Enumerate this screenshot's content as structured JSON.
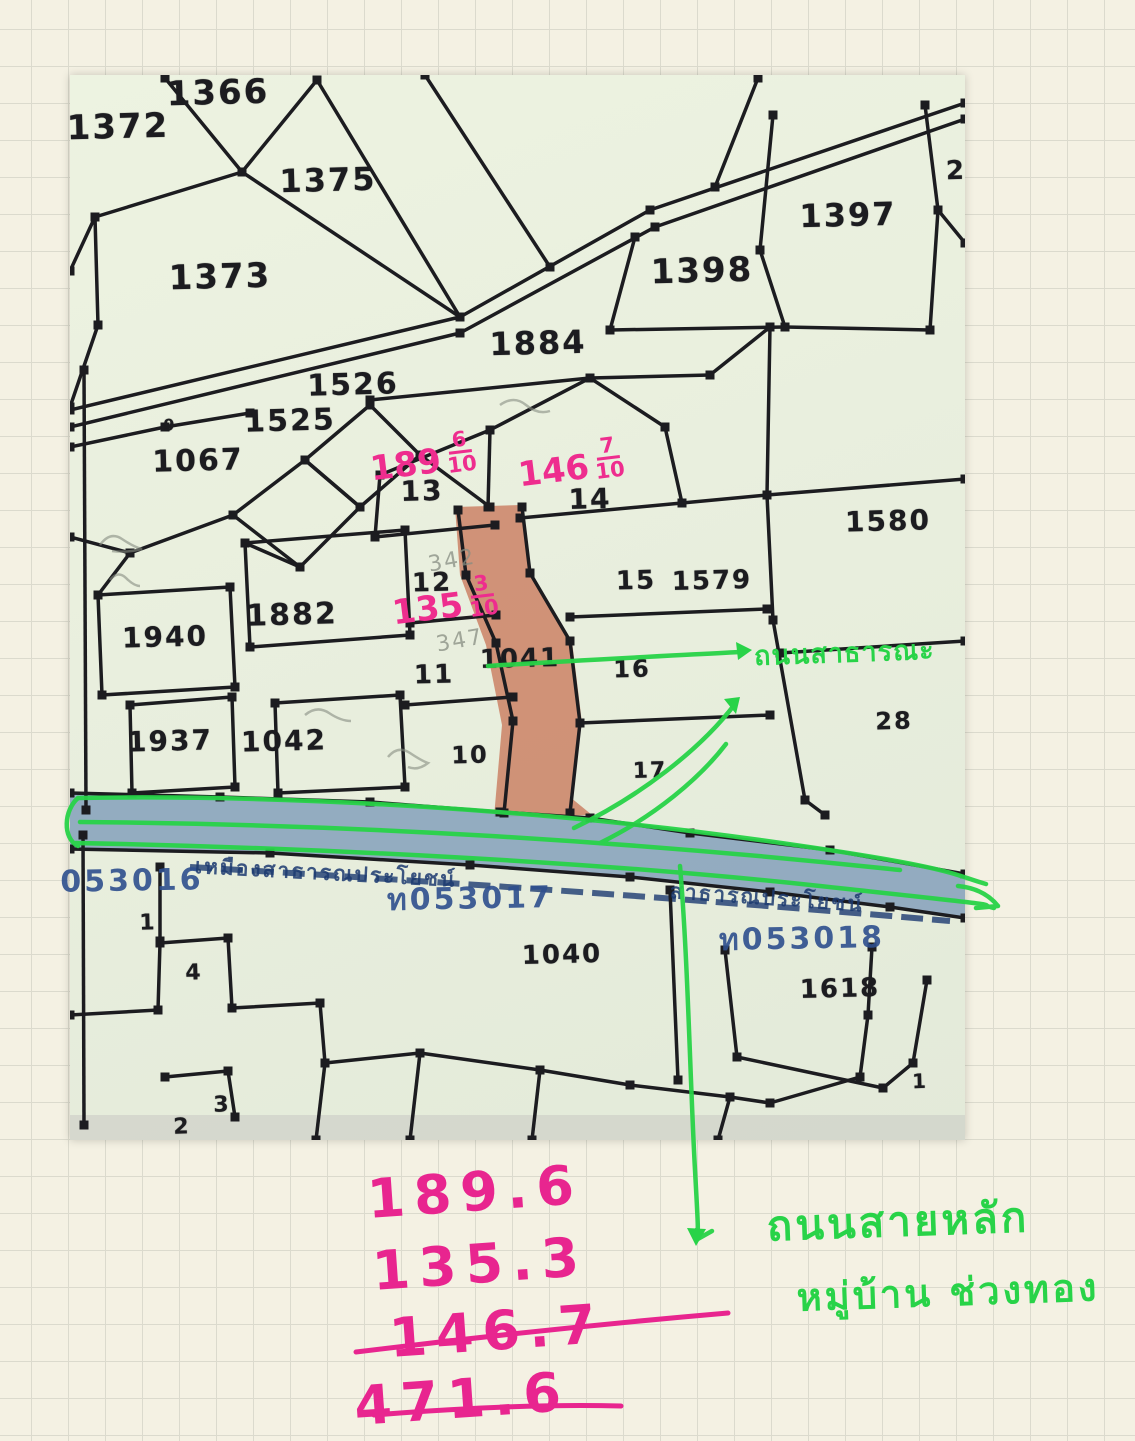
{
  "colors": {
    "map_ink": "#1c1c20",
    "salmon_highlight": "#c97a5e",
    "canal_blue": "#8aa4bd",
    "pen_green": "#28d348",
    "pen_pink": "#ee2d8e",
    "print_blue": "#2e4f8e",
    "canal_text_navy": "#1c3a70",
    "pencil_gray": "#878d82"
  },
  "map": {
    "parcel_labels": [
      {
        "t": "1366",
        "x": 148,
        "y": 18,
        "s": 34
      },
      {
        "t": "1372",
        "x": 48,
        "y": 52,
        "s": 34
      },
      {
        "t": "1375",
        "x": 258,
        "y": 105,
        "s": 32
      },
      {
        "t": "1373",
        "x": 150,
        "y": 202,
        "s": 34
      },
      {
        "t": "1398",
        "x": 632,
        "y": 196,
        "s": 34
      },
      {
        "t": "1397",
        "x": 778,
        "y": 140,
        "s": 32
      },
      {
        "t": "2",
        "x": 886,
        "y": 96,
        "s": 26
      },
      {
        "t": "1884",
        "x": 468,
        "y": 268,
        "s": 32
      },
      {
        "t": "1526",
        "x": 283,
        "y": 310,
        "s": 30
      },
      {
        "t": "1525",
        "x": 220,
        "y": 346,
        "s": 30
      },
      {
        "t": "1067",
        "x": 128,
        "y": 386,
        "s": 30
      },
      {
        "t": "9",
        "x": 100,
        "y": 350,
        "s": 16
      },
      {
        "t": "1580",
        "x": 818,
        "y": 446,
        "s": 28
      },
      {
        "t": "13",
        "x": 352,
        "y": 416,
        "s": 28
      },
      {
        "t": "14",
        "x": 520,
        "y": 424,
        "s": 28
      },
      {
        "t": "15",
        "x": 566,
        "y": 506,
        "s": 26
      },
      {
        "t": "1579",
        "x": 642,
        "y": 506,
        "s": 26
      },
      {
        "t": "12",
        "x": 362,
        "y": 508,
        "s": 26
      },
      {
        "t": "1882",
        "x": 222,
        "y": 540,
        "s": 30
      },
      {
        "t": "1940",
        "x": 95,
        "y": 562,
        "s": 28
      },
      {
        "t": "11",
        "x": 364,
        "y": 600,
        "s": 26
      },
      {
        "t": "1041",
        "x": 450,
        "y": 584,
        "s": 26
      },
      {
        "t": "16",
        "x": 562,
        "y": 594,
        "s": 24
      },
      {
        "t": "28",
        "x": 824,
        "y": 646,
        "s": 24
      },
      {
        "t": "1937",
        "x": 100,
        "y": 666,
        "s": 28
      },
      {
        "t": "1042",
        "x": 214,
        "y": 666,
        "s": 28
      },
      {
        "t": "10",
        "x": 400,
        "y": 680,
        "s": 24
      },
      {
        "t": "17",
        "x": 580,
        "y": 696,
        "s": 22
      },
      {
        "t": "1",
        "x": 78,
        "y": 848,
        "s": 22
      },
      {
        "t": "4",
        "x": 124,
        "y": 898,
        "s": 22
      },
      {
        "t": "1040",
        "x": 492,
        "y": 880,
        "s": 26
      },
      {
        "t": "1618",
        "x": 770,
        "y": 914,
        "s": 26
      },
      {
        "t": "3",
        "x": 152,
        "y": 1030,
        "s": 22
      },
      {
        "t": "2",
        "x": 112,
        "y": 1052,
        "s": 22
      },
      {
        "t": "1",
        "x": 850,
        "y": 1006,
        "s": 20
      }
    ],
    "blue_ids": [
      {
        "t": "053016",
        "x": 62,
        "y": 806
      },
      {
        "t": "ท053017",
        "x": 400,
        "y": 824
      },
      {
        "t": "ท053018",
        "x": 732,
        "y": 864
      }
    ],
    "canal_text": [
      {
        "t": "เหมืองสาธารณประโยชน์",
        "x": 125,
        "y": 775,
        "r": 3
      },
      {
        "t": "สาธารณประโยชน์",
        "x": 600,
        "y": 800,
        "r": 4
      }
    ],
    "pencil_notes": [
      {
        "t": "342",
        "x": 382,
        "y": 486
      },
      {
        "t": "347",
        "x": 390,
        "y": 566
      }
    ],
    "fractions": [
      {
        "w": "189",
        "n": "6",
        "d": "10",
        "x": 300,
        "y": 368
      },
      {
        "w": "146",
        "n": "7",
        "d": "10",
        "x": 448,
        "y": 374
      },
      {
        "w": "135",
        "n": "3",
        "d": "10",
        "x": 322,
        "y": 512
      }
    ],
    "green_road_label": {
      "t": "ถนนสาธารณะ"
    }
  },
  "annotations": {
    "green_note_line1": "ถนนสายหลัก",
    "green_note_line2": "หมู่บ้าน ช่วงทอง",
    "calc": {
      "addends": [
        "189.6",
        "135.3",
        "146.7"
      ],
      "total": "471.6"
    }
  }
}
